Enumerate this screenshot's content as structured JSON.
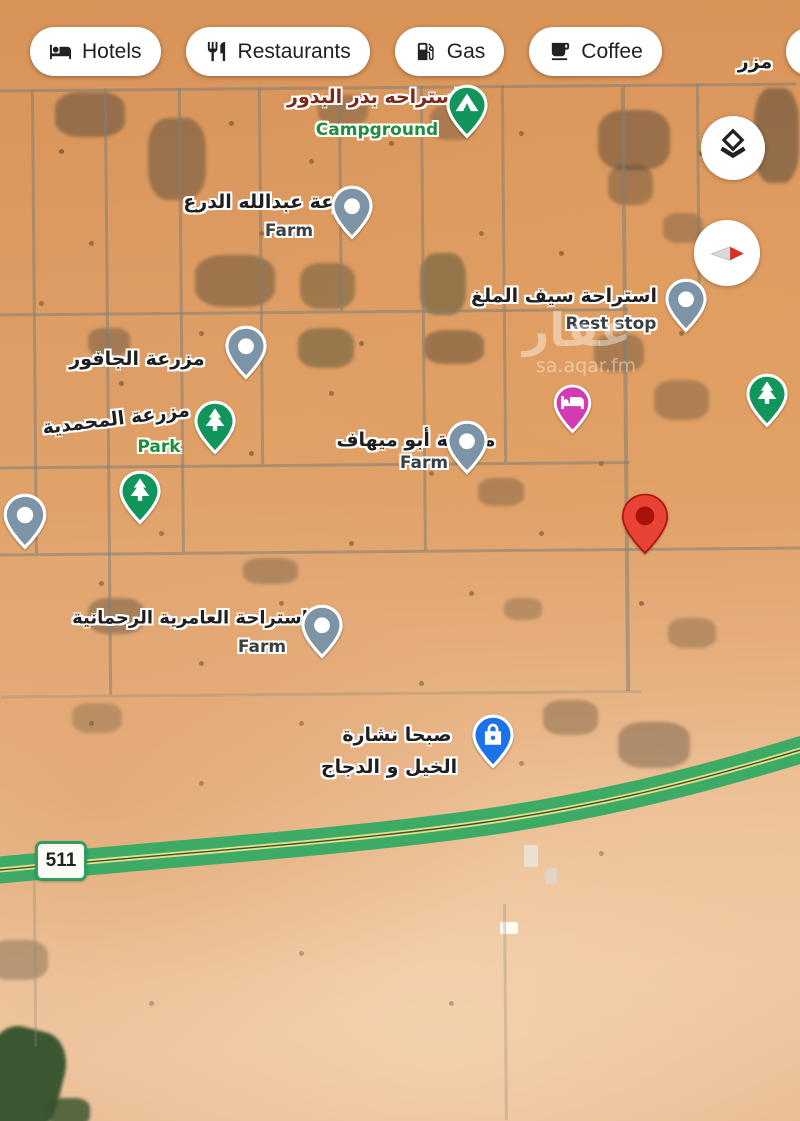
{
  "chips": [
    {
      "label": "Hotels",
      "icon": "hotel-icon"
    },
    {
      "label": "Restaurants",
      "icon": "restaurant-icon"
    },
    {
      "label": "Gas",
      "icon": "gas-icon"
    },
    {
      "label": "Coffee",
      "icon": "coffee-icon"
    },
    {
      "label": "",
      "icon": "shopping-icon"
    }
  ],
  "map_controls": {
    "layers": "layers",
    "compass": "compass"
  },
  "route_badge": {
    "number": "511"
  },
  "watermark": {
    "arabic": "عقار",
    "latin": "sa.aqar.fm"
  },
  "edge_label": "مزر",
  "pois": [
    {
      "id": "badr-albodour",
      "name_ar": "استراحه بدر البدور",
      "category": "Campground",
      "pin": "campground"
    },
    {
      "id": "abdullah-aldare",
      "name_ar": "مزرعة عبدالله الدرع",
      "category": "Farm",
      "pin": "farm"
    },
    {
      "id": "saif-almalagh",
      "name_ar": "استراحة سيف الملغ",
      "category": "Rest stop",
      "pin": "rest-stop"
    },
    {
      "id": "aljafoor",
      "name_ar": "مزرعة الجافور",
      "category": "",
      "pin": "farm"
    },
    {
      "id": "almohammadiya",
      "name_ar": "مزرعة المحمدية",
      "category": "Park",
      "pin": "park"
    },
    {
      "id": "abu-mihaf",
      "name_ar": "مزرعة أبو ميهاف",
      "category": "Farm",
      "pin": "farm"
    },
    {
      "id": "alamiriya",
      "name_ar": "استراحة العامرية الرحمانية",
      "category": "Farm",
      "pin": "farm"
    },
    {
      "id": "sabha-nashara",
      "name_ar": "صبحا نشارة",
      "name_ar_line2": "الخيل و الدجاج",
      "category": "",
      "pin": "shopping"
    }
  ],
  "colors": {
    "pin_gray": "#7d93a6",
    "pin_green": "#12955c",
    "pin_pink": "#d23bb3",
    "pin_blue": "#1a73e8",
    "pin_red": "#e94335",
    "pin_red_inner": "#a81208",
    "highway_green": "#3cab66",
    "highway_stripe": "#e3e08b",
    "label_green": "#1e8e3e",
    "campground_label": "#7b2a1a",
    "desert_base": "#dd9a5f"
  }
}
